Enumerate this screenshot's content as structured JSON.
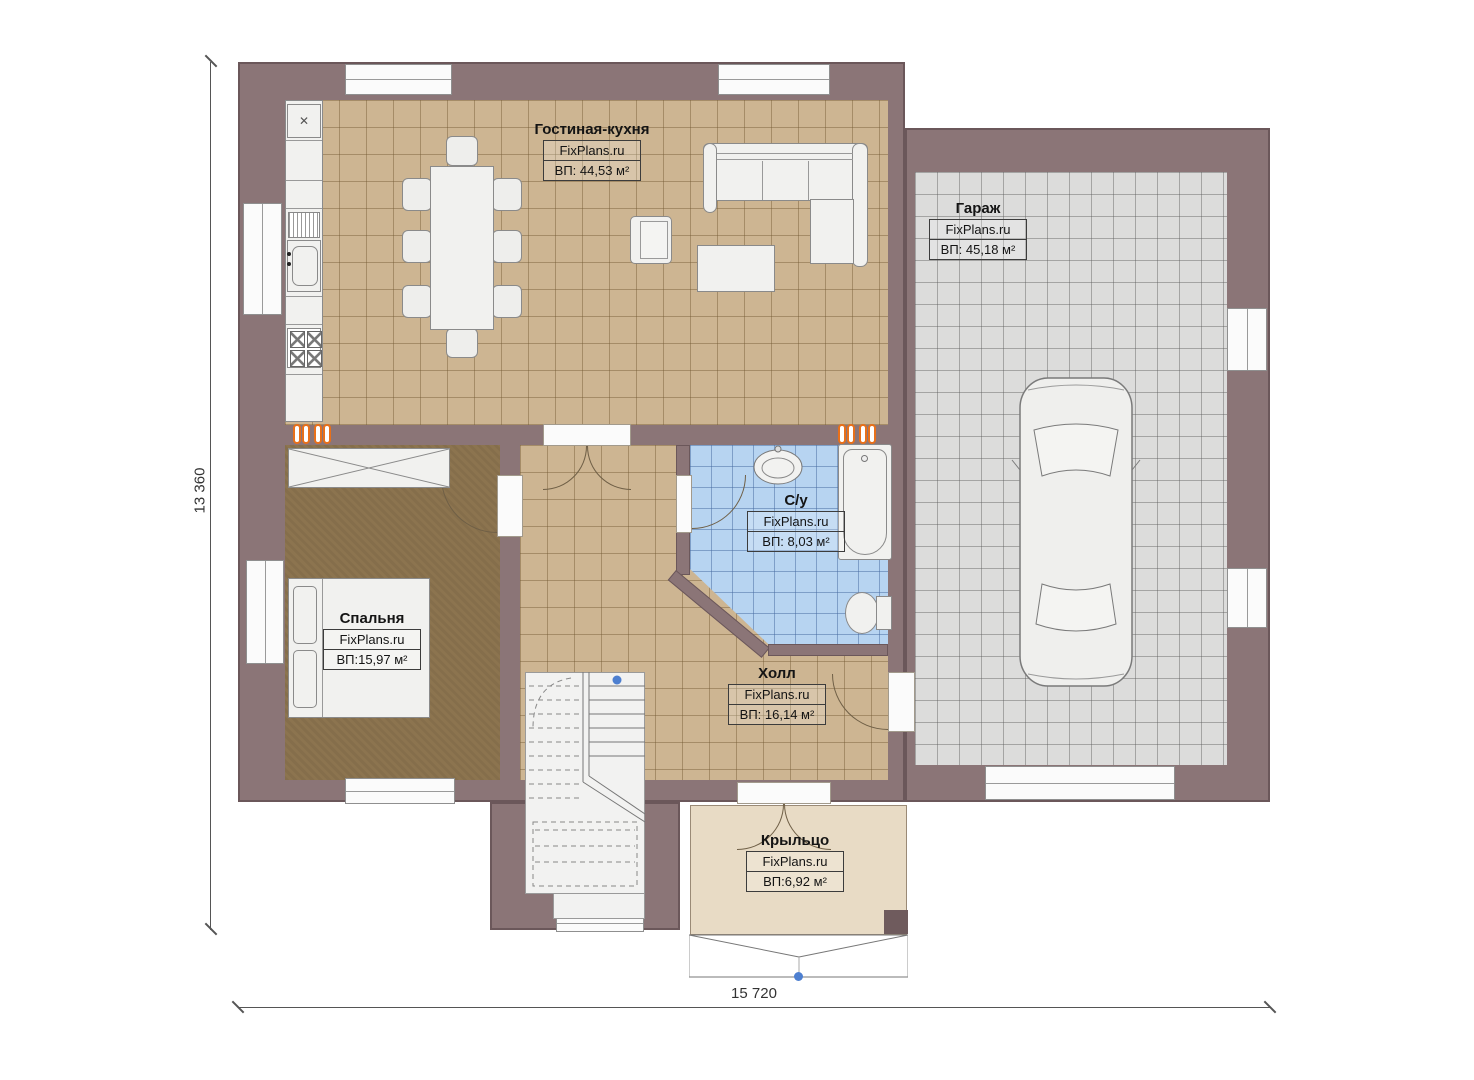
{
  "brand": "FixPlans.ru",
  "dimensions": {
    "height_total": "13 360",
    "width_total": "15 720"
  },
  "rooms": [
    {
      "name": "Гостиная-кухня",
      "brand": "FixPlans.ru",
      "area": "ВП: 44,53 м²"
    },
    {
      "name": "Гараж",
      "brand": "FixPlans.ru",
      "area": "ВП: 45,18 м²"
    },
    {
      "name": "С/у",
      "brand": "FixPlans.ru",
      "area": "ВП: 8,03 м²"
    },
    {
      "name": "Спальня",
      "brand": "FixPlans.ru",
      "area": "ВП:15,97 м²"
    },
    {
      "name": "Холл",
      "brand": "FixPlans.ru",
      "area": "ВП: 16,14 м²"
    },
    {
      "name": "Крыльцо",
      "brand": "FixPlans.ru",
      "area": "ВП:6,92 м²"
    }
  ],
  "icons": {
    "fridge_glyph": "✕"
  },
  "colors": {
    "wall": "#8b7577",
    "wall_outline": "#6b575a",
    "floor_living": "#cdb592",
    "floor_garage": "#dcdcdb",
    "floor_bath": "#b7d4f1",
    "floor_bedroom": "#8c744f",
    "floor_porch": "#e8dbc5",
    "furniture": "#f1f1ef",
    "radiator": "#e8701a",
    "marker": "#4d7fd0"
  }
}
